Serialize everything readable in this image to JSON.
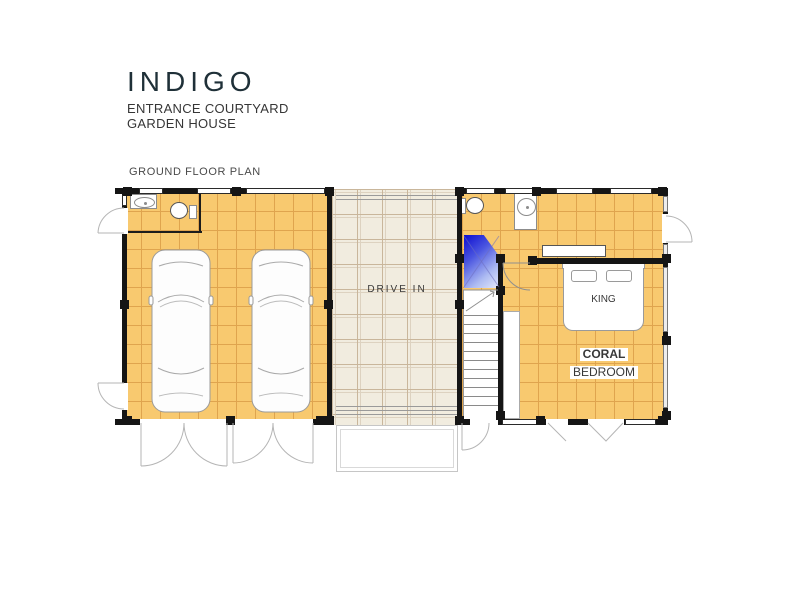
{
  "title_block": {
    "title": "INDIGO",
    "subtitle_line1": "ENTRANCE COURTYARD",
    "subtitle_line2": "GARDEN HOUSE",
    "plan_label": "GROUND FLOOR PLAN"
  },
  "rooms": {
    "drive_in": {
      "label": "DRIVE  IN"
    },
    "bedroom": {
      "name_line1": "CORAL",
      "name_line2": "BEDROOM",
      "bed_label": "KING"
    },
    "garage": {
      "car_count": 2
    }
  },
  "fixtures": [
    "car",
    "car",
    "sink",
    "toilet",
    "shower",
    "sink",
    "toilet",
    "staircase",
    "king-bed",
    "closet",
    "wardrobe"
  ],
  "colors": {
    "title": "#1F3038",
    "tile_orange": "#F8C96F",
    "tile_grid": "#DFA44E",
    "drive_floor": "#F1ECDF",
    "drive_grid": "#C9B69B",
    "wall": "#151515",
    "shower_dark": "#0D0DD0",
    "shower_light": "#C8D2F5",
    "fixture": "#8C8C8C",
    "door_arc": "#B5B5B5"
  }
}
